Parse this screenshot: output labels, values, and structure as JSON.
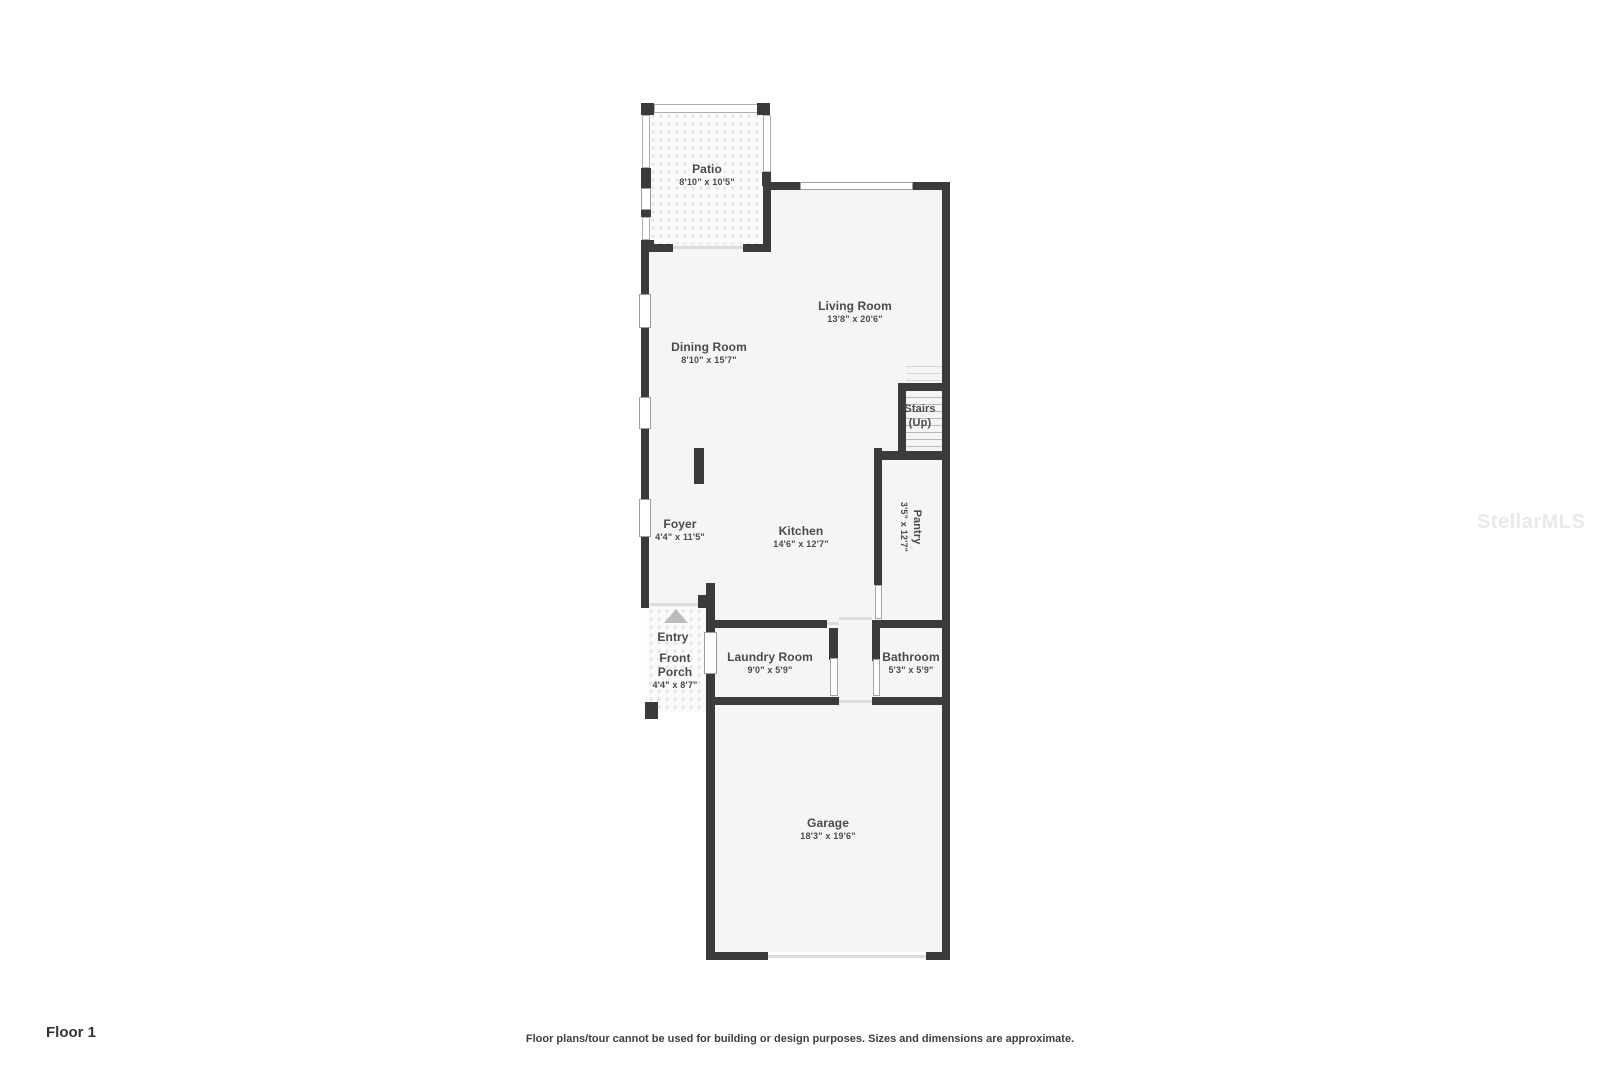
{
  "meta": {
    "floor_label": "Floor 1",
    "disclaimer": "Floor plans/tour cannot be used for building or design purposes. Sizes and dimensions are approximate.",
    "watermark": "StellarMLS"
  },
  "colors": {
    "wall": "#3b3b3b",
    "room_fill": "#f5f5f3",
    "label_text": "#4a4a4a",
    "watermark": "#e9e9ea"
  },
  "rooms": {
    "patio": {
      "name": "Patio",
      "dims": "8'10\" x 10'5\""
    },
    "living_room": {
      "name": "Living Room",
      "dims": "13'8\" x 20'6\""
    },
    "dining_room": {
      "name": "Dining Room",
      "dims": "8'10\" x 15'7\""
    },
    "stairs": {
      "name": "Stairs",
      "dims": "(Up)"
    },
    "pantry": {
      "name": "Pantry",
      "dims": "3'5\" x 12'7\""
    },
    "foyer": {
      "name": "Foyer",
      "dims": "4'4\" x 11'5\""
    },
    "kitchen": {
      "name": "Kitchen",
      "dims": "14'6\" x 12'7\""
    },
    "entry": {
      "name": "Entry"
    },
    "front_porch": {
      "name": "Front Porch",
      "dims": "4'4\" x 8'7\""
    },
    "laundry_room": {
      "name": "Laundry Room",
      "dims": "9'0\" x 5'9\""
    },
    "bathroom": {
      "name": "Bathroom",
      "dims": "5'3\" x 5'9\""
    },
    "garage": {
      "name": "Garage",
      "dims": "18'3\" x 19'6\""
    }
  }
}
